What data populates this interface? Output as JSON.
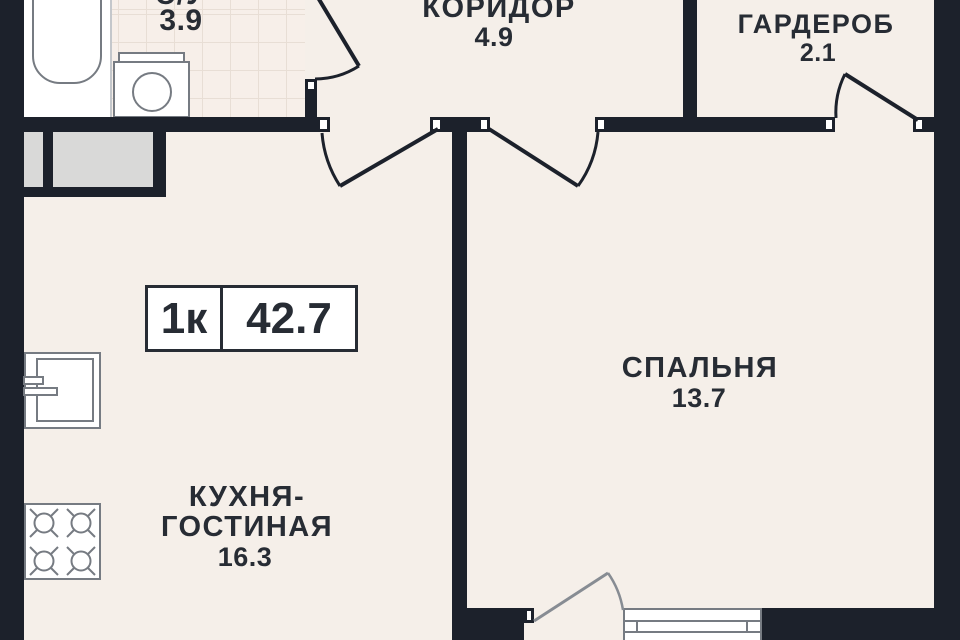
{
  "plan": {
    "badge": {
      "type_label": "1к",
      "total_area": "42.7"
    },
    "rooms": [
      {
        "id": "bathroom",
        "name": "С/У",
        "area": "3.9"
      },
      {
        "id": "corridor",
        "name": "КОРИДОР",
        "area": "4.9"
      },
      {
        "id": "wardrobe",
        "name": "ГАРДЕРОБ",
        "area": "2.1"
      },
      {
        "id": "bedroom",
        "name": "СПАЛЬНЯ",
        "area": "13.7"
      },
      {
        "id": "kitchen-living",
        "name_line1": "КУХНЯ-",
        "name_line2": "ГОСТИНАЯ",
        "area": "16.3"
      }
    ],
    "fixtures": [
      "bathtub",
      "washing-machine",
      "sink",
      "stove",
      "closet",
      "window",
      "balcony-door"
    ]
  },
  "colors": {
    "wall": "#1c212b",
    "floor": "#f5efe9",
    "tile": "#f7efe9",
    "tile-line": "#e8ded5",
    "fixture-line": "#767b82",
    "furniture": "#d9d9d8",
    "ink": "#272c34",
    "paper": "#ffffff"
  }
}
